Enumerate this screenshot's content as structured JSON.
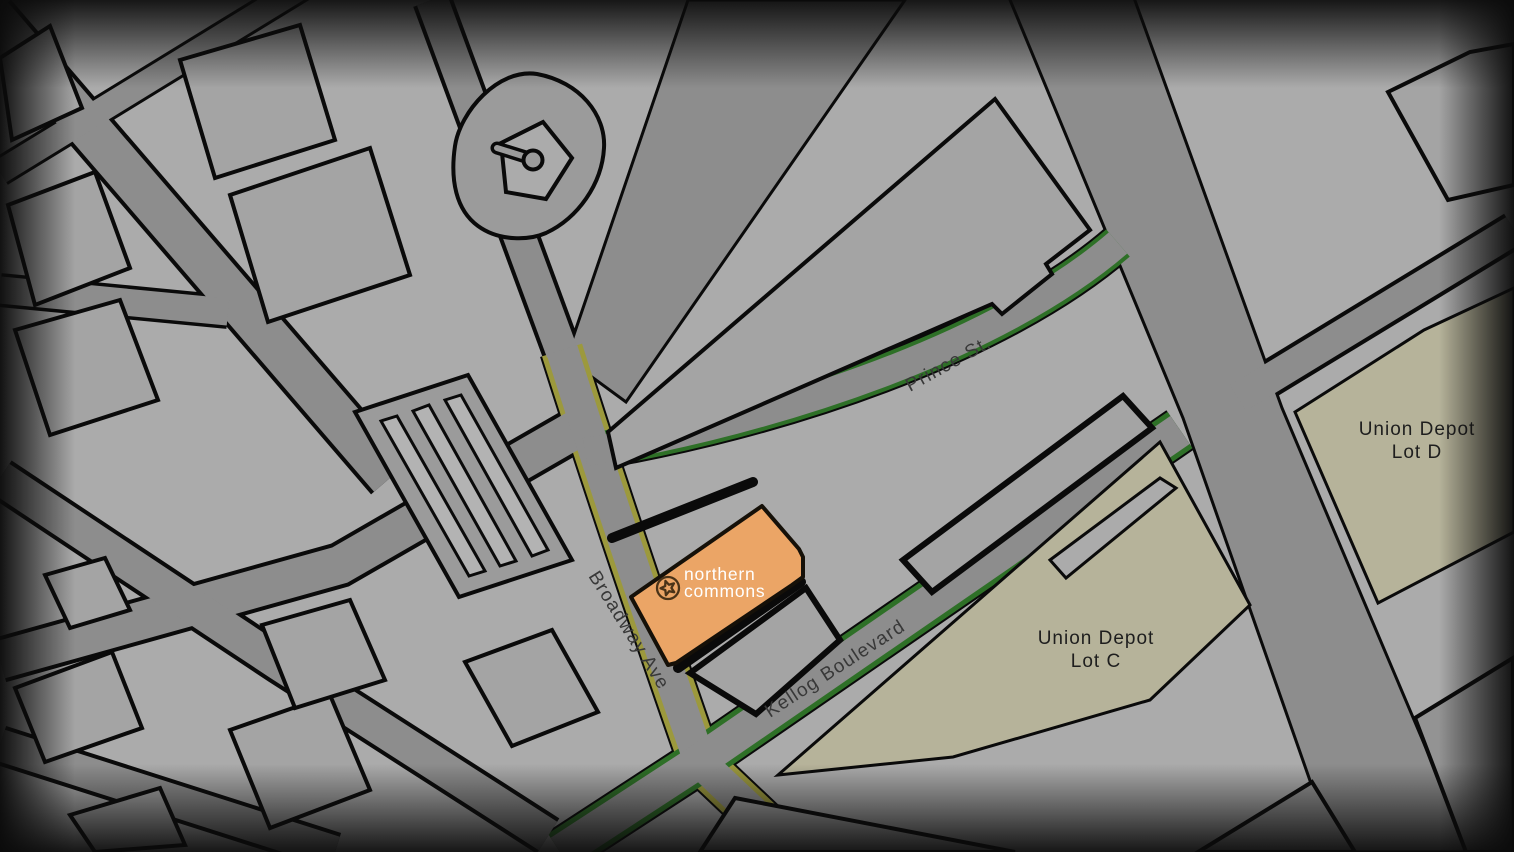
{
  "map": {
    "poi": {
      "name_line1": "northern",
      "name_line2": "commons",
      "icon": "star-in-circle-icon"
    },
    "street_labels": [
      {
        "id": "prince",
        "text": "Prince St."
      },
      {
        "id": "broadway",
        "text": "Broadway Ave"
      },
      {
        "id": "kellog",
        "text": "Kellog Boulevard"
      }
    ],
    "area_labels": [
      {
        "id": "lot-d",
        "line1": "Union Depot",
        "line2": "Lot D"
      },
      {
        "id": "lot-c",
        "line1": "Union Depot",
        "line2": "Lot C"
      }
    ],
    "colors": {
      "block": "#ababab",
      "road": "#8d8d8d",
      "building": "#a4a4a4",
      "building_dark": "#939393",
      "field": "#9b9b9b",
      "stripe": "#b3b3b3",
      "outline": "#0a0a0a",
      "poi_fill": "#eba566",
      "poi_icon": "#4a3318",
      "lot_fill": "#b6b39a",
      "green_edge": "#2e7027",
      "olive_edge": "#9c993d",
      "street_label": "#383838",
      "area_label": "#1e1e1e",
      "poi_label": "#ffffff"
    }
  }
}
